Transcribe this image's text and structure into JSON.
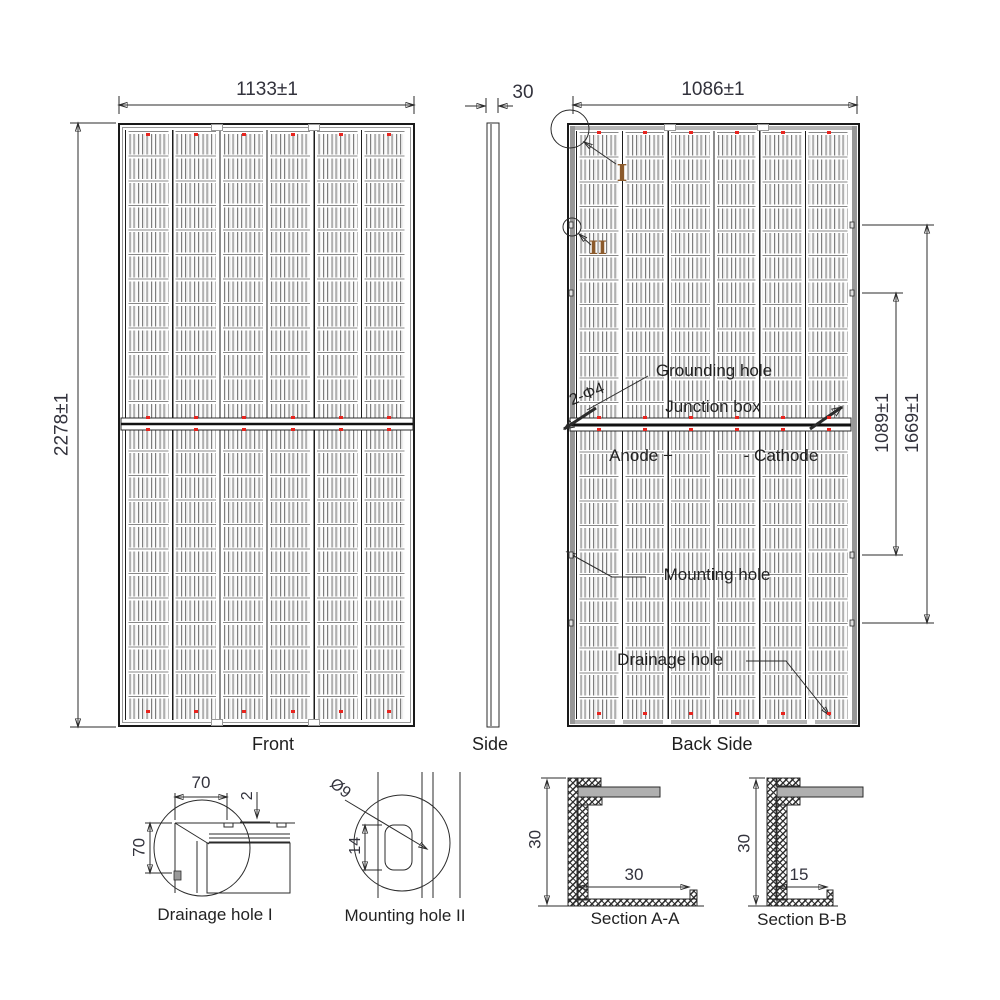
{
  "drawing": {
    "views": {
      "front": {
        "label": "Front",
        "dim_width": "1133±1",
        "dim_height": "2278±1"
      },
      "side": {
        "label": "Side",
        "dim_thickness": "30"
      },
      "back": {
        "label": "Back Side",
        "dim_width": "1086±1",
        "dim_mount_inner": "1089±1",
        "dim_mount_outer": "1669±1",
        "callout_grounding": "Grounding hole",
        "callout_spec": "2-Φ4",
        "callout_junction": "Junction box",
        "callout_anode": "Anode +",
        "callout_cathode": "- Cathode",
        "callout_mounting": "Mounting hole",
        "callout_drainage": "Drainage hole",
        "marker_1": "I",
        "marker_2": "II"
      }
    },
    "details": {
      "drainage": {
        "title": "Drainage hole I",
        "dim_width": "70",
        "dim_lip": "2",
        "dim_height": "70"
      },
      "mounting": {
        "title": "Mounting hole II",
        "dim_dia": "Ø9",
        "dim_len": "14"
      },
      "section_a": {
        "title": "Section A-A",
        "dim_height": "30",
        "dim_flange": "30"
      },
      "section_b": {
        "title": "Section B-B",
        "dim_height": "30",
        "dim_flange": "15"
      }
    },
    "panel": {
      "columns": 6,
      "cell_rows": 24
    },
    "colors": {
      "red_dot": "#e8251f",
      "marker_text": "#8b5a2b",
      "line": "#2b2b2b",
      "dim_text": "#32323c"
    }
  }
}
